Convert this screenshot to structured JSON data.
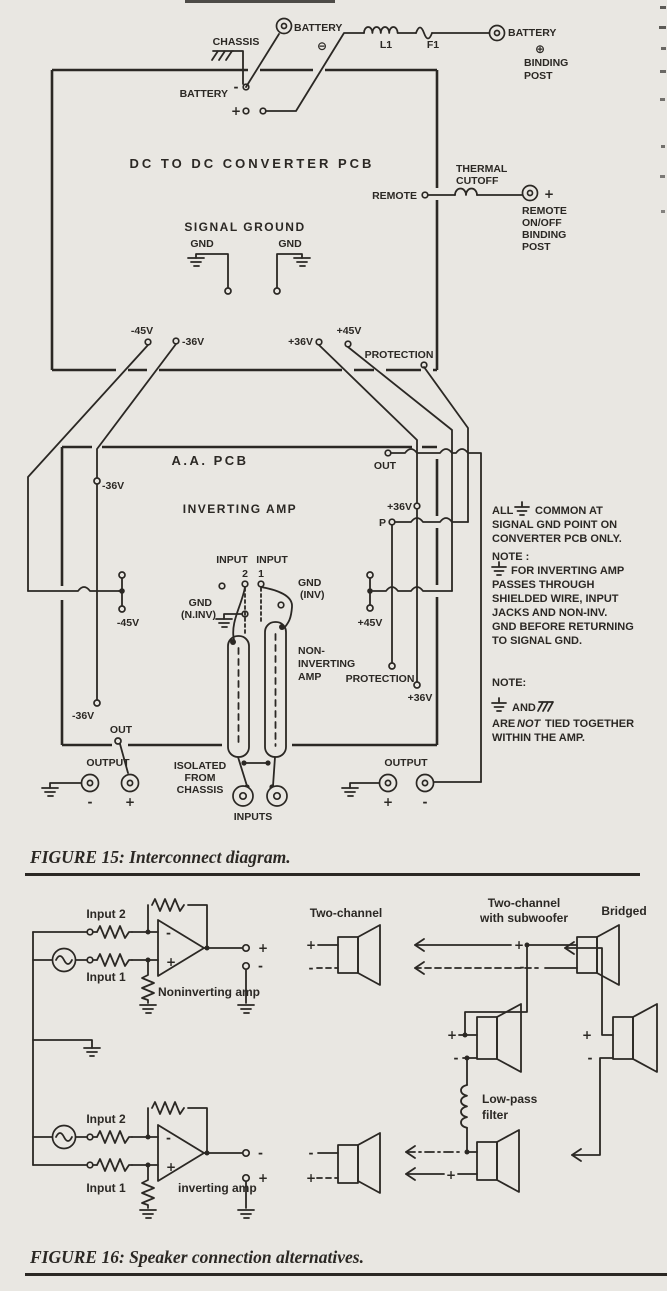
{
  "page": {
    "bg_color": "#e9e7e2",
    "ink_color": "#2b2824"
  },
  "sym": {
    "plus": "+",
    "minus": "-",
    "circle_plus": "⊕",
    "circle_minus": "⊖"
  },
  "f15": {
    "caption": "FIGURE 15: Interconnect diagram.",
    "converter": {
      "title": "DC TO DC CONVERTER PCB",
      "chassis": "CHASSIS",
      "battery_left": "BATTERY",
      "battery_neg_post": "BATTERY",
      "l1": "L1",
      "f1": "F1",
      "battery_pos_post": "BATTERY",
      "binding": "BINDING",
      "post": "POST",
      "signal_ground": "SIGNAL GROUND",
      "gnd": "GND",
      "remote": "REMOTE",
      "thermal1": "THERMAL",
      "thermal2": "CUTOFF",
      "remote_post": [
        "REMOTE",
        "ON/OFF",
        "BINDING",
        "POST"
      ],
      "v_neg45": "-45V",
      "v_neg36": "-36V",
      "v_pos36": "+36V",
      "v_pos45": "+45V",
      "protection": "PROTECTION"
    },
    "aa": {
      "title": "A.A. PCB",
      "out": "OUT",
      "v_neg36": "-36V",
      "inverting": "INVERTING AMP",
      "v_pos36": "+36V",
      "p": "P",
      "input": "INPUT",
      "n2": "2",
      "n1": "1",
      "gnd": "GND",
      "inv": "(INV)",
      "ninv": "(N.INV)",
      "v_neg45": "-45V",
      "v_pos45": "+45V",
      "noninv1": "NON-",
      "noninv2": "INVERTING",
      "noninv3": "AMP",
      "protection": "PROTECTION"
    },
    "bottom": {
      "output": "OUTPUT",
      "iso1": "ISOLATED",
      "iso2": "FROM",
      "iso3": "CHASSIS",
      "inputs": "INPUTS"
    },
    "notes": {
      "all": "ALL",
      "common": "COMMON AT",
      "l2": "SIGNAL GND POINT ON",
      "l3": "CONVERTER PCB ONLY.",
      "note1": "NOTE :",
      "n2": [
        "FOR INVERTING AMP",
        "PASSES THROUGH",
        "SHIELDED WIRE, INPUT",
        "JACKS AND NON-INV.",
        "GND BEFORE RETURNING",
        "TO SIGNAL GND."
      ],
      "note2": "NOTE:",
      "and": "AND",
      "are": "ARE",
      "not": "NOT",
      "tied": "TIED TOGETHER",
      "within": "WITHIN THE AMP."
    }
  },
  "f16": {
    "caption": "FIGURE 16: Speaker connection alternatives.",
    "input2": "Input 2",
    "input1": "Input 1",
    "noninv": "Noninverting amp",
    "inv": "inverting amp",
    "two_channel": "Two-channel",
    "sub1": "Two-channel",
    "sub2": "with subwoofer",
    "bridged": "Bridged",
    "lowpass1": "Low-pass",
    "lowpass2": "filter"
  }
}
